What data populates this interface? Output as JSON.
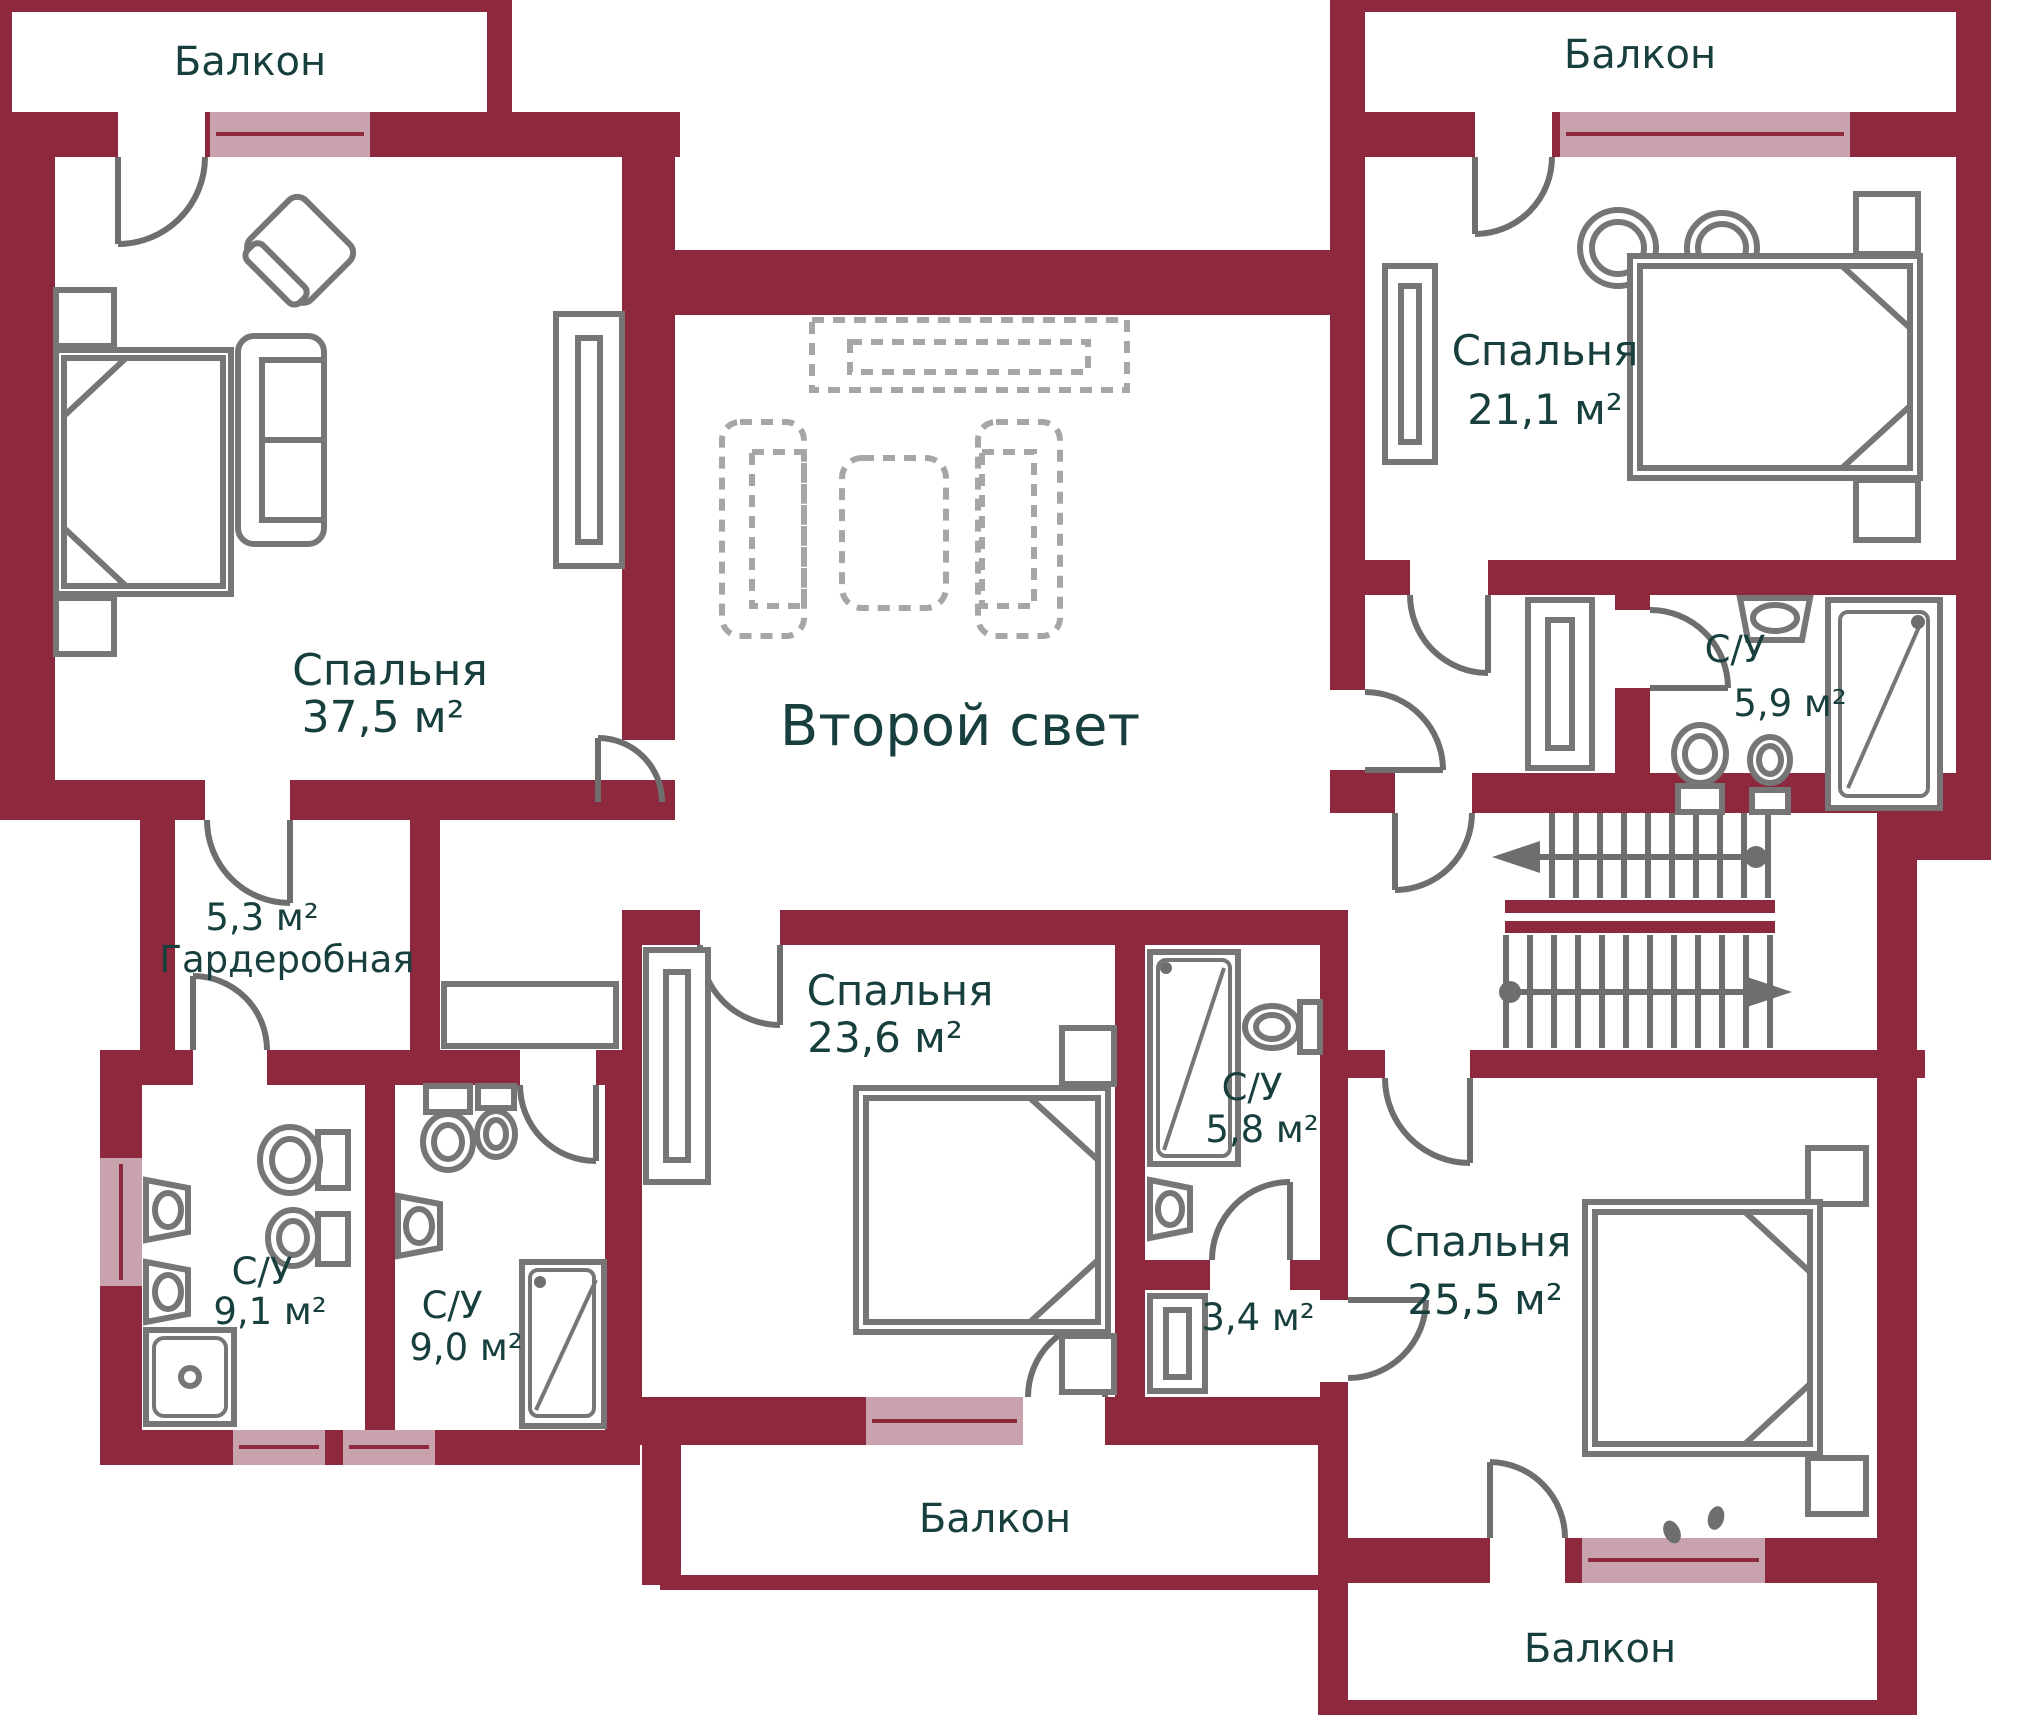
{
  "colors": {
    "wall": "#8E293D",
    "window": "#C8A3AD",
    "furniture": "#767676",
    "furniture_light": "#A6A6A6",
    "door": "#6E6E6E",
    "stairs": "#6E6E6E",
    "dots": "#8A8A8A",
    "text": "#173F3D"
  },
  "rooms": {
    "balcony_top_left": {
      "label": "Балкон"
    },
    "bedroom_top_left": {
      "label": "Спальня",
      "area": "37,5 м²"
    },
    "wardrobe": {
      "area": "5,3 м²",
      "label": "Гардеробная"
    },
    "lounge": {
      "label": "Второй свет"
    },
    "balcony_top_right": {
      "label": "Балкон"
    },
    "bedroom_top_right": {
      "label": "Спальня",
      "area": "21,1 м²"
    },
    "bathroom_top_right": {
      "label": "С/У",
      "area": "5,9 м²"
    },
    "bathroom_left_1": {
      "label": "С/У",
      "area": "9,1 м²"
    },
    "bathroom_left_2": {
      "label": "С/У",
      "area": "9,0 м²"
    },
    "bedroom_center": {
      "label": "Спальня",
      "area": "23,6 м²"
    },
    "bathroom_center": {
      "label": "С/У",
      "area": "5,8 м²"
    },
    "closet": {
      "area": "3,4 м²"
    },
    "bedroom_bottom_right": {
      "label": "Спальня",
      "area": "25,5 м²"
    },
    "balcony_bottom_center": {
      "label": "Балкон"
    },
    "balcony_bottom_right": {
      "label": "Балкон"
    }
  }
}
